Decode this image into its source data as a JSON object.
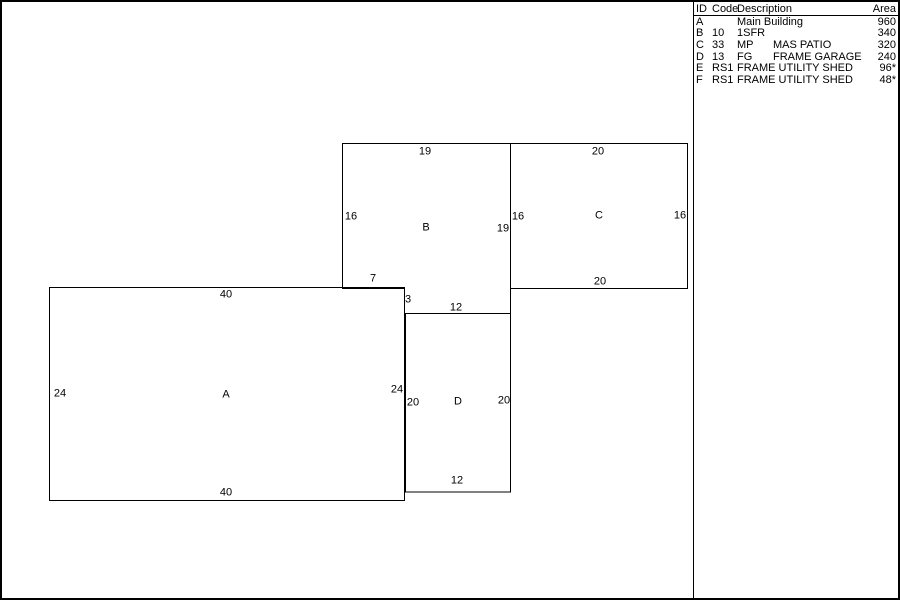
{
  "colors": {
    "line": "#000000",
    "background": "#ffffff",
    "text": "#000000"
  },
  "legend": {
    "headers": {
      "id": "ID",
      "code": "Code",
      "description": "Description",
      "area": "Area"
    },
    "rows": [
      {
        "id": "A",
        "code": "",
        "desc_prefix": "",
        "desc": "Main Building",
        "area": "960"
      },
      {
        "id": "B",
        "code": "10",
        "desc_prefix": "",
        "desc": "1SFR",
        "area": "340"
      },
      {
        "id": "C",
        "code": "33",
        "desc_prefix": "MP",
        "desc": "MAS PATIO",
        "area": "320"
      },
      {
        "id": "D",
        "code": "13",
        "desc_prefix": "FG",
        "desc": "FRAME GARAGE",
        "area": "240"
      },
      {
        "id": "E",
        "code": "RS1",
        "desc_prefix": "",
        "desc": "FRAME UTILITY SHED",
        "area": "96*"
      },
      {
        "id": "F",
        "code": "RS1",
        "desc_prefix": "",
        "desc": "FRAME UTILITY SHED",
        "area": "48*"
      }
    ]
  },
  "sketch": {
    "shapes": [
      {
        "id": "A",
        "dims": {
          "top": "40",
          "left": "24",
          "center": "A",
          "right": "24",
          "bottom": "40"
        }
      },
      {
        "id": "B",
        "dims": {
          "top": "19",
          "left": "16",
          "center": "B",
          "right": "19",
          "notch_bottom": "7",
          "notch_side": "3",
          "bottom": "12"
        }
      },
      {
        "id": "C",
        "dims": {
          "top": "20",
          "left": "16",
          "center": "C",
          "right": "16",
          "bottom": "20"
        }
      },
      {
        "id": "D",
        "dims": {
          "left": "20",
          "center": "D",
          "right": "20",
          "bottom": "12"
        }
      }
    ]
  }
}
